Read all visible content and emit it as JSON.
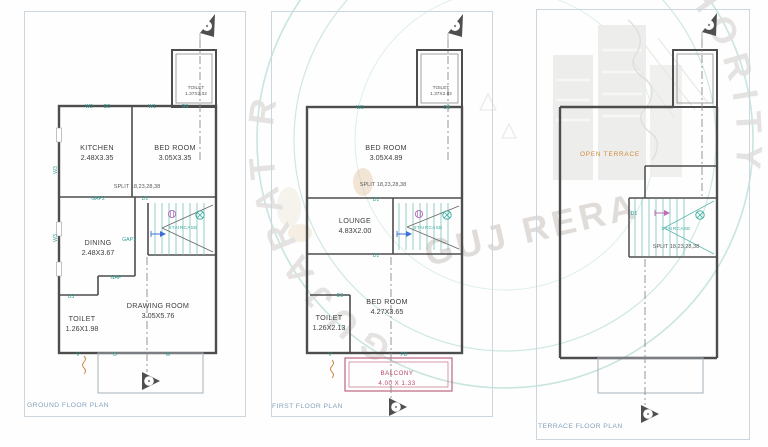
{
  "watermark": {
    "seal_arc_left": "GUJARAT R",
    "seal_arc_right": "AUTHORITY",
    "center_text": "GUJ RERA"
  },
  "colors": {
    "wall": "#4d4d4d",
    "opening_label": "#2f9e93",
    "stair": "#7cc4ba",
    "balcony": "#bb4a66",
    "open_terrace": "#cf8a3e",
    "plan_title": "#86a3bd",
    "watermark_circle": "#c2e2da",
    "watermark_text": "#e2e1df"
  },
  "plans": [
    {
      "title": "GROUND FLOOR PLAN",
      "shaft_room": {
        "name": "TOILET",
        "dim": "1.37X2.02"
      },
      "rooms": {
        "kitchen": {
          "name": "KITCHEN",
          "dim": "2.48X3.35"
        },
        "bedroom": {
          "name": "BED ROOM",
          "dim": "3.05X3.35"
        },
        "dining": {
          "name": "DINING",
          "dim": "2.48X3.67"
        },
        "drawing": {
          "name": "DRAWING ROOM",
          "dim": "3.05X5.76"
        },
        "toilet": {
          "name": "TOILET",
          "dim": "1.26X1.98"
        }
      },
      "split_note": "SPLIT 18,23,28,38",
      "staircase": "STAIRCASE",
      "labels": {
        "w2": "W2",
        "d2": "D2",
        "w1": "W1",
        "d3_top": "D3",
        "w3_upper": "W3",
        "w3_lower": "W3",
        "gap2": "GAP2",
        "d1": "D1",
        "gap1": "GAP1",
        "gap": "GAP",
        "d3_toilet": "D3",
        "v": "V",
        "d": "D",
        "w": "W"
      }
    },
    {
      "title": "FIRST FLOOR PLAN",
      "shaft_room": {
        "name": "TOILET",
        "dim": "1.37X2.02"
      },
      "rooms": {
        "bedroom_large": {
          "name": "BED ROOM",
          "dim": "3.05X4.89"
        },
        "lounge": {
          "name": "LOUNGE",
          "dim": "4.83X2.00"
        },
        "bedroom_small": {
          "name": "BED ROOM",
          "dim": "4.27X3.65"
        },
        "toilet": {
          "name": "TOILET",
          "dim": "1.26X2.13"
        },
        "balcony": {
          "name": "BALCONY",
          "dim": "4.00 X 1.33"
        }
      },
      "split_note": "SPLIT 18,23,28,38",
      "staircase": "STAIRCASE",
      "labels": {
        "w3": "W3",
        "d3_top": "D3",
        "d1_upper": "D1",
        "d1_lower": "D1",
        "d3_toilet": "D3",
        "v": "V",
        "fd": "FD"
      }
    },
    {
      "title": "TERRACE FLOOR PLAN",
      "rooms": {
        "open_terrace": {
          "name": "OPEN TERRACE"
        }
      },
      "split_note": "SPLIT 18,23,28,38",
      "staircase": "STAIRCASE",
      "labels": {
        "d1": "D1"
      }
    }
  ]
}
